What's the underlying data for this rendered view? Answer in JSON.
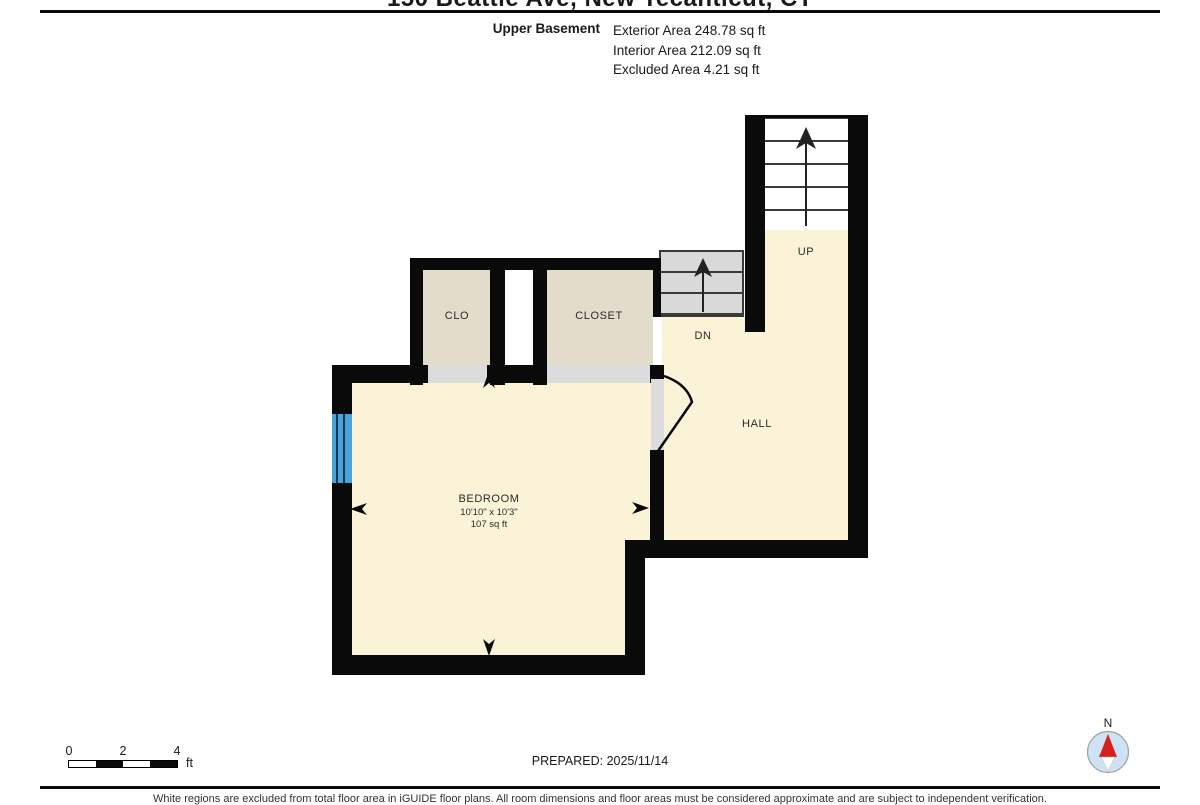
{
  "header": {
    "title": "150 Beattie Ave, New Tecanticut, CT",
    "floor_name": "Upper Basement",
    "stats": [
      "Exterior Area 248.78 sq ft",
      "Interior Area 212.09 sq ft",
      "Excluded Area 4.21 sq ft"
    ]
  },
  "rooms": {
    "bedroom": {
      "name": "BEDROOM",
      "dims": "10'10\" x 10'3\"",
      "area": "107 sq ft"
    },
    "clo": "CLO",
    "closet": "CLOSET",
    "hall": "HALL",
    "stairs_up": "UP",
    "stairs_dn": "DN"
  },
  "footer": {
    "scale": {
      "ticks": [
        "0",
        "2",
        "4"
      ],
      "unit": "ft"
    },
    "prepared": "PREPARED: 2025/11/14",
    "compass_label": "N",
    "disclaimer": "White regions are excluded from total floor area in iGUIDE floor plans. All room dimensions and floor areas must be considered approximate and are subject to independent verification."
  },
  "colors": {
    "wall": "#0a0a0a",
    "floor": "#fbf3d8",
    "closet": "#e4dccb",
    "doorgray": "#dcdcdc",
    "stair": "#d9d9d9",
    "window": "#4aa3d8",
    "compassbg": "#cde3f4",
    "compassred": "#d81f1f"
  }
}
